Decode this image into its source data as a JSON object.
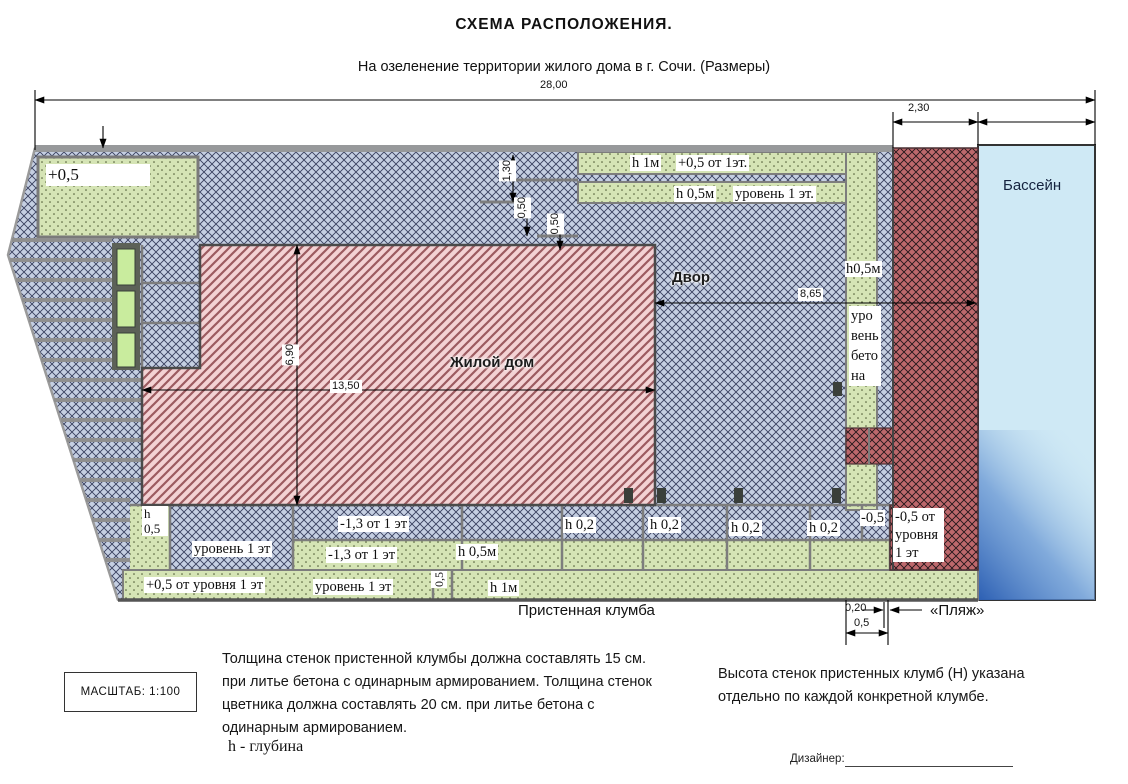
{
  "header": {
    "title": "СХЕМА  РАСПОЛОЖЕНИЯ.",
    "subtitle": "На озеленение территории жилого дома в г. Сочи. (Размеры)"
  },
  "plan": {
    "area_labels": {
      "pool": "Бассейн",
      "yard": "Двор",
      "house": "Жилой дом",
      "beach": "«Пляж»",
      "wall_bed_caption": "Пристенная клумба"
    },
    "dims": {
      "total_width": "28,00",
      "wall_width": "2,30",
      "yard_width": "8,65",
      "house_width": "13,50",
      "house_height": "6,90",
      "v130": "1,30",
      "v050a": "0,50",
      "v050b": "0,50",
      "b020": "0,20",
      "b05": "0,5"
    },
    "beds": {
      "top_left": "+0,5",
      "strip1_h": "h 1м",
      "strip1_level": "+0,5 от 1эт.",
      "strip2_h": "h 0,5м",
      "strip2_level": "уровень 1 эт.",
      "right_h": "h0,5м",
      "right_level": "уро вень бето на",
      "col_h": "h 0,5",
      "level1_a": "уровень 1 эт",
      "m13_a": "-1,3 от 1 эт",
      "m13_b": "-1,3 от 1 эт",
      "h02": [
        "h 0,2",
        "h 0,2",
        "h 0,2",
        "h 0,2"
      ],
      "m05": "-0,5",
      "m05_long": "-0,5 от уровня 1 эт",
      "h05_b": "h 0,5м",
      "plus05_long": "+0,5 от уровня 1 эт",
      "level1_b": "уровень 1 эт",
      "v05": "0,5",
      "h1_b": "h 1м"
    }
  },
  "footer": {
    "scale": "МАСШТАБ:  1:100",
    "note_left": "Толщина стенок пристенной клумбы должна составлять 15 см. при литье бетона с одинарным армированием. Толщина стенок цветника должна составлять 20 см. при литье бетона с одинарным армированием.",
    "note_right": "Высота стенок пристенных клумб (Н) указана отдельно по каждой конкретной клумбе.",
    "legend": "h - глубина",
    "designer": "Дизайнер:"
  },
  "colors": {
    "hatch_bg": "#c5cfe2",
    "house_bg": "#f3d2d4",
    "wall_bg": "#bd686c",
    "bed_bg": "#d5e4b5",
    "pool": "#cfe9f5",
    "pool_deep": "#2c5fb3"
  }
}
